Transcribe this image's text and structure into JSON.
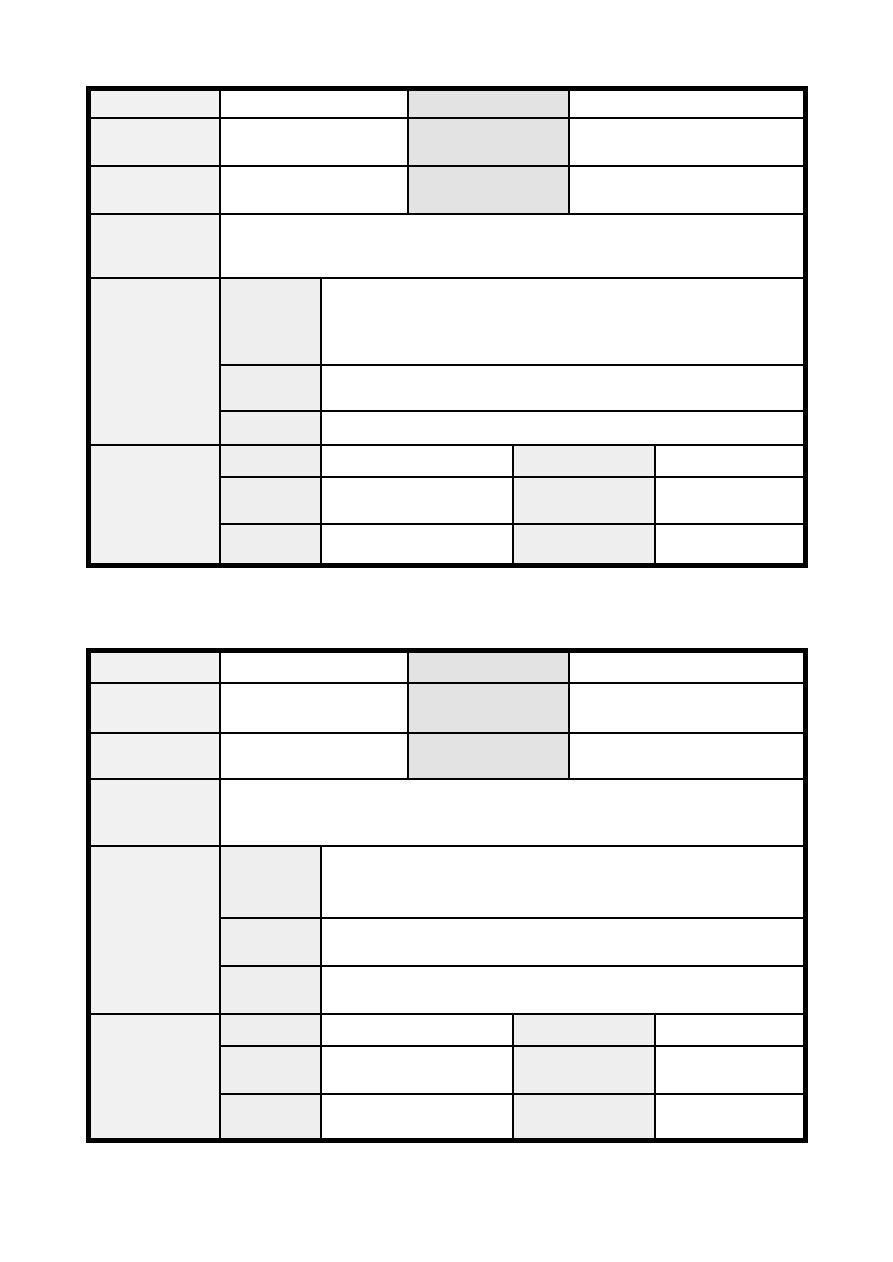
{
  "page": {
    "width": 893,
    "height": 1262,
    "background": "#ffffff",
    "content_text": ""
  },
  "colors": {
    "border": "#000000",
    "header_fill": "#f1f1f1",
    "accent_fill": "#e3e3e3",
    "subheader_fill": "#eeeeee",
    "cell_fill": "#ffffff"
  },
  "tables": [
    {
      "name": "form-table-1",
      "left": 86,
      "top": 86,
      "width": 717,
      "col_widths": [
        131,
        101,
        87,
        105,
        56,
        86,
        151
      ],
      "row_heights": [
        29,
        48,
        48,
        64,
        87,
        46,
        34,
        32,
        47,
        42
      ],
      "rows": [
        [
          {
            "colspan": 1,
            "rowspan": 1,
            "fill": "header_fill",
            "name": "row-header-cell",
            "text": ""
          },
          {
            "colspan": 2,
            "rowspan": 1,
            "fill": "cell_fill",
            "name": "field-cell",
            "text": ""
          },
          {
            "colspan": 2,
            "rowspan": 1,
            "fill": "accent_fill",
            "name": "accent-header-cell",
            "text": ""
          },
          {
            "colspan": 2,
            "rowspan": 1,
            "fill": "cell_fill",
            "name": "field-cell",
            "text": ""
          }
        ],
        [
          {
            "colspan": 1,
            "rowspan": 1,
            "fill": "header_fill",
            "name": "row-header-cell",
            "text": ""
          },
          {
            "colspan": 2,
            "rowspan": 1,
            "fill": "cell_fill",
            "name": "field-cell",
            "text": ""
          },
          {
            "colspan": 2,
            "rowspan": 1,
            "fill": "accent_fill",
            "name": "accent-header-cell",
            "text": ""
          },
          {
            "colspan": 2,
            "rowspan": 1,
            "fill": "cell_fill",
            "name": "field-cell",
            "text": ""
          }
        ],
        [
          {
            "colspan": 1,
            "rowspan": 1,
            "fill": "header_fill",
            "name": "row-header-cell",
            "text": ""
          },
          {
            "colspan": 2,
            "rowspan": 1,
            "fill": "cell_fill",
            "name": "field-cell",
            "text": ""
          },
          {
            "colspan": 2,
            "rowspan": 1,
            "fill": "accent_fill",
            "name": "accent-header-cell",
            "text": ""
          },
          {
            "colspan": 2,
            "rowspan": 1,
            "fill": "cell_fill",
            "name": "field-cell",
            "text": ""
          }
        ],
        [
          {
            "colspan": 1,
            "rowspan": 1,
            "fill": "header_fill",
            "name": "row-header-cell",
            "text": ""
          },
          {
            "colspan": 6,
            "rowspan": 1,
            "fill": "cell_fill",
            "name": "field-cell-wide",
            "text": ""
          }
        ],
        [
          {
            "colspan": 1,
            "rowspan": 3,
            "fill": "header_fill",
            "name": "section-header-cell",
            "text": ""
          },
          {
            "colspan": 1,
            "rowspan": 1,
            "fill": "subheader_fill",
            "name": "sub-header-cell",
            "text": ""
          },
          {
            "colspan": 5,
            "rowspan": 1,
            "fill": "cell_fill",
            "name": "field-cell",
            "text": ""
          }
        ],
        [
          {
            "colspan": 1,
            "rowspan": 1,
            "fill": "subheader_fill",
            "name": "sub-header-cell",
            "text": ""
          },
          {
            "colspan": 5,
            "rowspan": 1,
            "fill": "cell_fill",
            "name": "field-cell",
            "text": ""
          }
        ],
        [
          {
            "colspan": 1,
            "rowspan": 1,
            "fill": "subheader_fill",
            "name": "sub-header-cell",
            "text": ""
          },
          {
            "colspan": 5,
            "rowspan": 1,
            "fill": "cell_fill",
            "name": "field-cell",
            "text": ""
          }
        ],
        [
          {
            "colspan": 1,
            "rowspan": 3,
            "fill": "header_fill",
            "name": "section-header-cell",
            "text": ""
          },
          {
            "colspan": 1,
            "rowspan": 1,
            "fill": "subheader_fill",
            "name": "sub-header-cell",
            "text": ""
          },
          {
            "colspan": 2,
            "rowspan": 1,
            "fill": "cell_fill",
            "name": "field-cell",
            "text": ""
          },
          {
            "colspan": 2,
            "rowspan": 1,
            "fill": "subheader_fill",
            "name": "sub-header-cell",
            "text": ""
          },
          {
            "colspan": 1,
            "rowspan": 1,
            "fill": "cell_fill",
            "name": "field-cell",
            "text": ""
          }
        ],
        [
          {
            "colspan": 1,
            "rowspan": 1,
            "fill": "subheader_fill",
            "name": "sub-header-cell",
            "text": ""
          },
          {
            "colspan": 2,
            "rowspan": 1,
            "fill": "cell_fill",
            "name": "field-cell",
            "text": ""
          },
          {
            "colspan": 2,
            "rowspan": 1,
            "fill": "subheader_fill",
            "name": "sub-header-cell",
            "text": ""
          },
          {
            "colspan": 1,
            "rowspan": 1,
            "fill": "cell_fill",
            "name": "field-cell",
            "text": ""
          }
        ],
        [
          {
            "colspan": 1,
            "rowspan": 1,
            "fill": "subheader_fill",
            "name": "sub-header-cell",
            "text": ""
          },
          {
            "colspan": 2,
            "rowspan": 1,
            "fill": "cell_fill",
            "name": "field-cell",
            "text": ""
          },
          {
            "colspan": 2,
            "rowspan": 1,
            "fill": "subheader_fill",
            "name": "sub-header-cell",
            "text": ""
          },
          {
            "colspan": 1,
            "rowspan": 1,
            "fill": "cell_fill",
            "name": "field-cell",
            "text": ""
          }
        ]
      ]
    },
    {
      "name": "form-table-2",
      "left": 86,
      "top": 648,
      "width": 717,
      "col_widths": [
        131,
        101,
        87,
        105,
        56,
        86,
        151
      ],
      "row_heights": [
        32,
        50,
        46,
        67,
        72,
        48,
        48,
        32,
        48,
        47
      ],
      "rows": [
        [
          {
            "colspan": 1,
            "rowspan": 1,
            "fill": "header_fill",
            "name": "row-header-cell",
            "text": ""
          },
          {
            "colspan": 2,
            "rowspan": 1,
            "fill": "cell_fill",
            "name": "field-cell",
            "text": ""
          },
          {
            "colspan": 2,
            "rowspan": 1,
            "fill": "accent_fill",
            "name": "accent-header-cell",
            "text": ""
          },
          {
            "colspan": 2,
            "rowspan": 1,
            "fill": "cell_fill",
            "name": "field-cell",
            "text": ""
          }
        ],
        [
          {
            "colspan": 1,
            "rowspan": 1,
            "fill": "header_fill",
            "name": "row-header-cell",
            "text": ""
          },
          {
            "colspan": 2,
            "rowspan": 1,
            "fill": "cell_fill",
            "name": "field-cell",
            "text": ""
          },
          {
            "colspan": 2,
            "rowspan": 1,
            "fill": "accent_fill",
            "name": "accent-header-cell",
            "text": ""
          },
          {
            "colspan": 2,
            "rowspan": 1,
            "fill": "cell_fill",
            "name": "field-cell",
            "text": ""
          }
        ],
        [
          {
            "colspan": 1,
            "rowspan": 1,
            "fill": "header_fill",
            "name": "row-header-cell",
            "text": ""
          },
          {
            "colspan": 2,
            "rowspan": 1,
            "fill": "cell_fill",
            "name": "field-cell",
            "text": ""
          },
          {
            "colspan": 2,
            "rowspan": 1,
            "fill": "accent_fill",
            "name": "accent-header-cell",
            "text": ""
          },
          {
            "colspan": 2,
            "rowspan": 1,
            "fill": "cell_fill",
            "name": "field-cell",
            "text": ""
          }
        ],
        [
          {
            "colspan": 1,
            "rowspan": 1,
            "fill": "header_fill",
            "name": "row-header-cell",
            "text": ""
          },
          {
            "colspan": 6,
            "rowspan": 1,
            "fill": "cell_fill",
            "name": "field-cell-wide",
            "text": ""
          }
        ],
        [
          {
            "colspan": 1,
            "rowspan": 3,
            "fill": "header_fill",
            "name": "section-header-cell",
            "text": ""
          },
          {
            "colspan": 1,
            "rowspan": 1,
            "fill": "subheader_fill",
            "name": "sub-header-cell",
            "text": ""
          },
          {
            "colspan": 5,
            "rowspan": 1,
            "fill": "cell_fill",
            "name": "field-cell",
            "text": ""
          }
        ],
        [
          {
            "colspan": 1,
            "rowspan": 1,
            "fill": "subheader_fill",
            "name": "sub-header-cell",
            "text": ""
          },
          {
            "colspan": 5,
            "rowspan": 1,
            "fill": "cell_fill",
            "name": "field-cell",
            "text": ""
          }
        ],
        [
          {
            "colspan": 1,
            "rowspan": 1,
            "fill": "subheader_fill",
            "name": "sub-header-cell",
            "text": ""
          },
          {
            "colspan": 5,
            "rowspan": 1,
            "fill": "cell_fill",
            "name": "field-cell",
            "text": ""
          }
        ],
        [
          {
            "colspan": 1,
            "rowspan": 3,
            "fill": "header_fill",
            "name": "section-header-cell",
            "text": ""
          },
          {
            "colspan": 1,
            "rowspan": 1,
            "fill": "subheader_fill",
            "name": "sub-header-cell",
            "text": ""
          },
          {
            "colspan": 2,
            "rowspan": 1,
            "fill": "cell_fill",
            "name": "field-cell",
            "text": ""
          },
          {
            "colspan": 2,
            "rowspan": 1,
            "fill": "subheader_fill",
            "name": "sub-header-cell",
            "text": ""
          },
          {
            "colspan": 1,
            "rowspan": 1,
            "fill": "cell_fill",
            "name": "field-cell",
            "text": ""
          }
        ],
        [
          {
            "colspan": 1,
            "rowspan": 1,
            "fill": "subheader_fill",
            "name": "sub-header-cell",
            "text": ""
          },
          {
            "colspan": 2,
            "rowspan": 1,
            "fill": "cell_fill",
            "name": "field-cell",
            "text": ""
          },
          {
            "colspan": 2,
            "rowspan": 1,
            "fill": "subheader_fill",
            "name": "sub-header-cell",
            "text": ""
          },
          {
            "colspan": 1,
            "rowspan": 1,
            "fill": "cell_fill",
            "name": "field-cell",
            "text": ""
          }
        ],
        [
          {
            "colspan": 1,
            "rowspan": 1,
            "fill": "subheader_fill",
            "name": "sub-header-cell",
            "text": ""
          },
          {
            "colspan": 2,
            "rowspan": 1,
            "fill": "cell_fill",
            "name": "field-cell",
            "text": ""
          },
          {
            "colspan": 2,
            "rowspan": 1,
            "fill": "subheader_fill",
            "name": "sub-header-cell",
            "text": ""
          },
          {
            "colspan": 1,
            "rowspan": 1,
            "fill": "cell_fill",
            "name": "field-cell",
            "text": ""
          }
        ]
      ]
    }
  ]
}
